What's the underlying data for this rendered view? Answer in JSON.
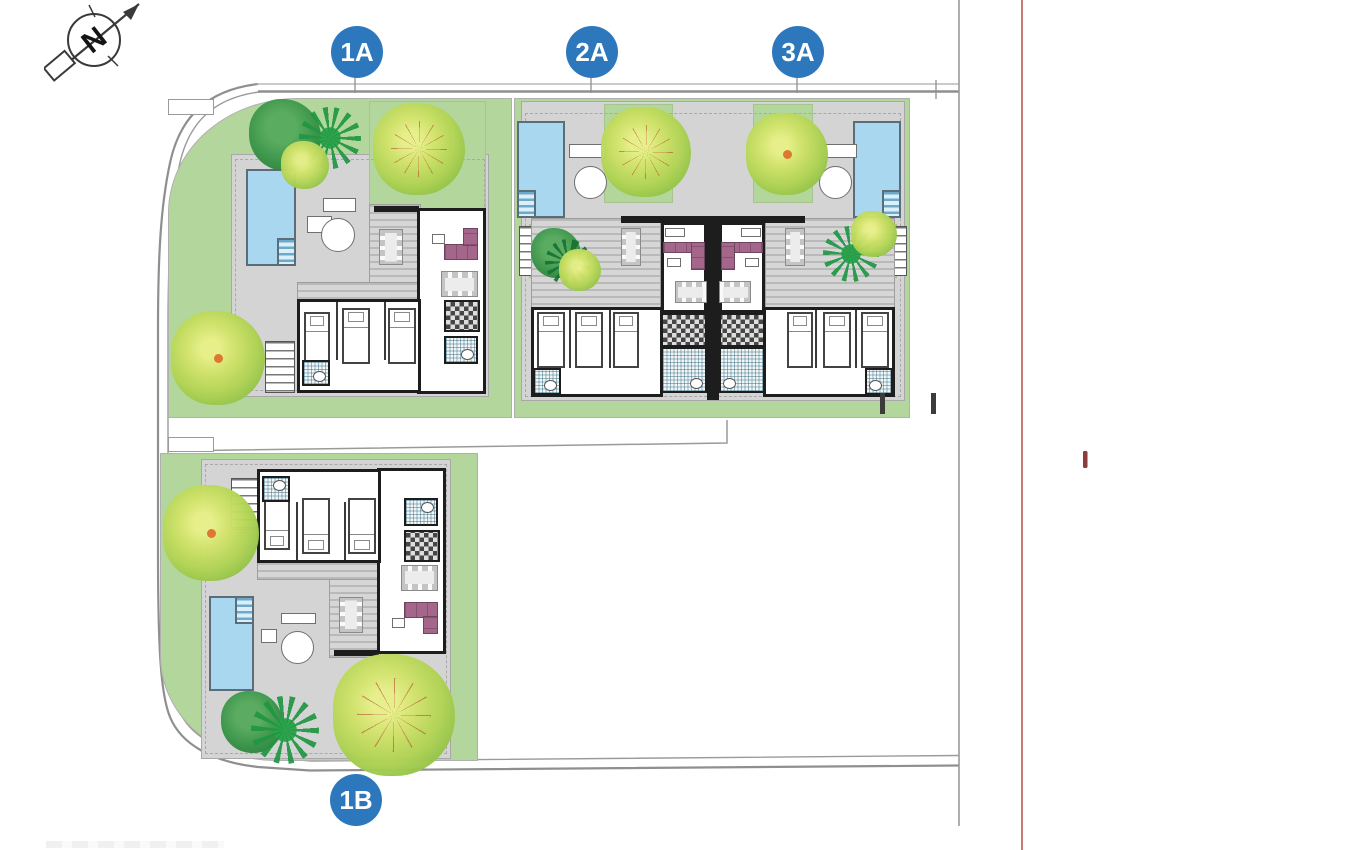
{
  "plan": {
    "compass": {
      "letter": "N",
      "icon": "north-arrow-icon"
    },
    "badges": [
      {
        "id": "1A",
        "label": "1A"
      },
      {
        "id": "2A",
        "label": "2A"
      },
      {
        "id": "3A",
        "label": "3A"
      },
      {
        "id": "1B",
        "label": "1B"
      }
    ],
    "colors": {
      "badge_blue": "#2d78bd",
      "garden_green": "#b3d69c",
      "patio_gray": "#d4d4d4",
      "pool_blue": "#a9d7ef",
      "wall_black": "#1d1d1d",
      "deck_stripe_gray": "#bdbdbd",
      "sofa_plum": "#a4678b",
      "bath_teal": "#34788f",
      "road_gray": "#8f8f8f",
      "guide_line_red": "#c97c75",
      "marker_red": "#8e3b3b",
      "tree_yellow_green": "#c9dd67",
      "tree_dark_green": "#2e8b3d",
      "palm_green": "#27a44b",
      "tree_accent_orange": "#e0742c"
    }
  }
}
